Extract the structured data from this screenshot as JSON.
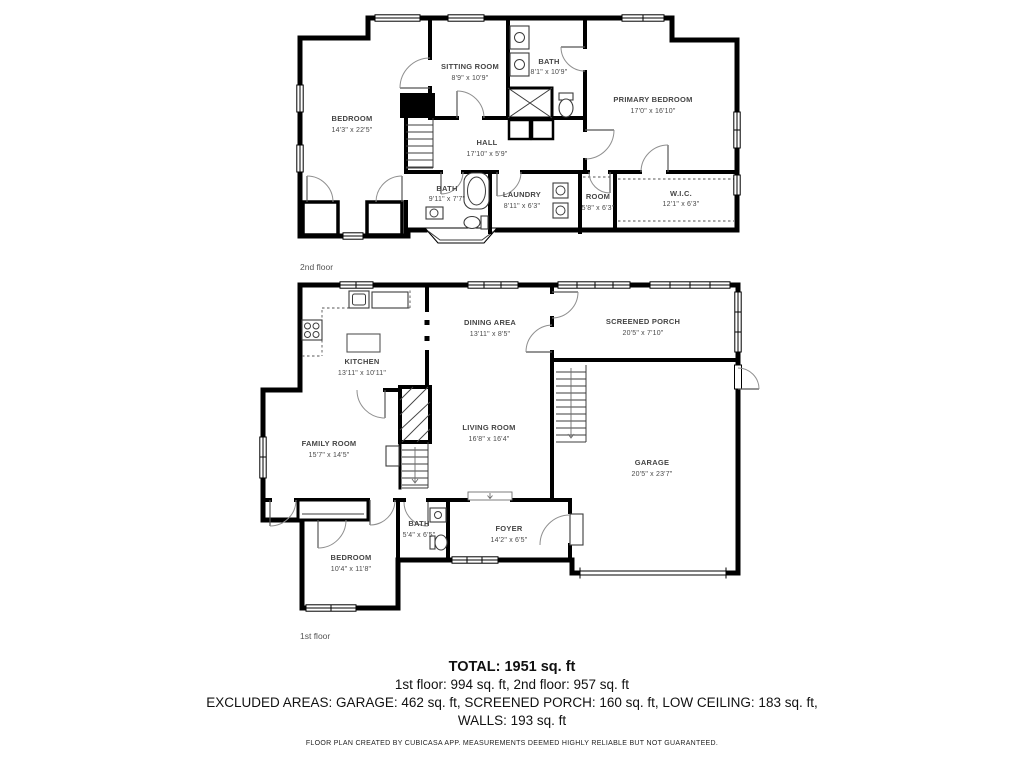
{
  "floors": {
    "second": {
      "label": "2nd floor",
      "rooms": {
        "bedroom": {
          "name": "BEDROOM",
          "dims": "14'3\" x 22'5\""
        },
        "sitting_room": {
          "name": "SITTING ROOM",
          "dims": "8'9\" x 10'9\""
        },
        "bath_top": {
          "name": "BATH",
          "dims": "8'1\" x 10'9\""
        },
        "primary_bedroom": {
          "name": "PRIMARY BEDROOM",
          "dims": "17'0\" x 16'10\""
        },
        "hall": {
          "name": "HALL",
          "dims": "17'10\" x 5'9\""
        },
        "bath_lower": {
          "name": "BATH",
          "dims": "9'11\" x 7'7\""
        },
        "laundry": {
          "name": "LAUNDRY",
          "dims": "8'11\" x 6'3\""
        },
        "room": {
          "name": "ROOM",
          "dims": "5'8\" x 6'3\""
        },
        "wic": {
          "name": "W.I.C.",
          "dims": "12'1\" x 6'3\""
        }
      }
    },
    "first": {
      "label": "1st floor",
      "rooms": {
        "kitchen": {
          "name": "KITCHEN",
          "dims": "13'11\" x 10'11\""
        },
        "dining_area": {
          "name": "DINING AREA",
          "dims": "13'11\" x 8'5\""
        },
        "screened_porch": {
          "name": "SCREENED PORCH",
          "dims": "20'5\" x 7'10\""
        },
        "family_room": {
          "name": "FAMILY ROOM",
          "dims": "15'7\" x 14'5\""
        },
        "living_room": {
          "name": "LIVING ROOM",
          "dims": "16'8\" x 16'4\""
        },
        "garage": {
          "name": "GARAGE",
          "dims": "20'5\" x 23'7\""
        },
        "bedroom": {
          "name": "BEDROOM",
          "dims": "10'4\" x 11'8\""
        },
        "bath": {
          "name": "BATH",
          "dims": "5'4\" x 6'5\""
        },
        "foyer": {
          "name": "FOYER",
          "dims": "14'2\" x 6'5\""
        }
      }
    }
  },
  "summary": {
    "total": "TOTAL: 1951 sq. ft",
    "floors_line": "1st floor: 994 sq. ft, 2nd floor: 957 sq. ft",
    "excluded_line1": "EXCLUDED AREAS: GARAGE: 462 sq. ft, SCREENED PORCH: 160 sq. ft, LOW CEILING: 183 sq. ft,",
    "excluded_line2": "WALLS: 193 sq. ft",
    "disclaimer": "FLOOR PLAN CREATED BY CUBICASA APP. MEASUREMENTS DEEMED HIGHLY RELIABLE BUT NOT GUARANTEED."
  },
  "colors": {
    "wall": "#000000",
    "background": "#ffffff",
    "label_text": "#454545"
  }
}
